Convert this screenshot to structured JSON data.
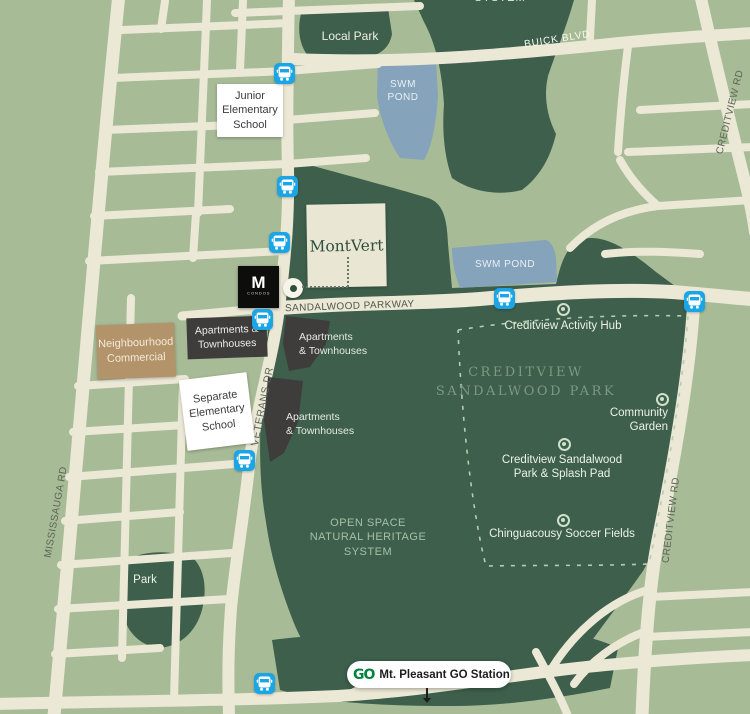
{
  "colors": {
    "background": "#a7bb97",
    "road": "#ebe8d6",
    "park_dark": "#3d5f4c",
    "pond_blue": "#85a3ba",
    "commercial_tan": "#b3936a",
    "apartments_dark": "#3e3d3b",
    "bus_blue": "#19a5e6",
    "go_green": "#00843d",
    "montvert_bg": "#e9e6d3",
    "montvert_text": "#2f4e3d"
  },
  "road_labels": {
    "mississauga": "MISSISSAUGA RD",
    "veterans": "VETERANS DR",
    "sandalwood": "SANDALWOOD PARKWAY WEST",
    "buick": "BUICK BLVD",
    "creditview_north": "CREDITVIEW RD",
    "creditview_south": "CREDITVIEW RD"
  },
  "areas": {
    "local_park": "Local Park",
    "park_small": "Park",
    "swm_pond_north": "SWM\nPOND",
    "swm_pond_east": "SWM POND",
    "open_space": "OPEN SPACE\nNATURAL HERITAGE\nSYSTEM",
    "creditview_sandalwood_park": "CREDITVIEW\nSANDALWOOD PARK",
    "system_cutoff": "SYSTEM"
  },
  "poi": {
    "activity_hub": "Creditview Activity Hub",
    "community_garden": "Community\nGarden",
    "splash_pad": "Creditview Sandalwood\nPark & Splash Pad",
    "soccer_fields": "Chinguacousy Soccer Fields"
  },
  "buildings": {
    "junior_school": "Junior\nElementary\nSchool",
    "separate_school": "Separate\nElementary\nSchool",
    "neighbourhood_commercial": "Neighbourhood\nCommercial",
    "apartments_a": "Apartments &\nTownhouses",
    "apartments_b": "Apartments\n& Townhouses",
    "apartments_c": "Apartments\n& Townhouses",
    "montvert": "MontVert",
    "m_condos_m": "M",
    "m_condos_sub": "CONDOS"
  },
  "transit": {
    "go_station": "Mt. Pleasant GO Station",
    "go_logo": "GO",
    "bus_icon": "bus-stop",
    "marker_icon": "park-poi-marker"
  }
}
